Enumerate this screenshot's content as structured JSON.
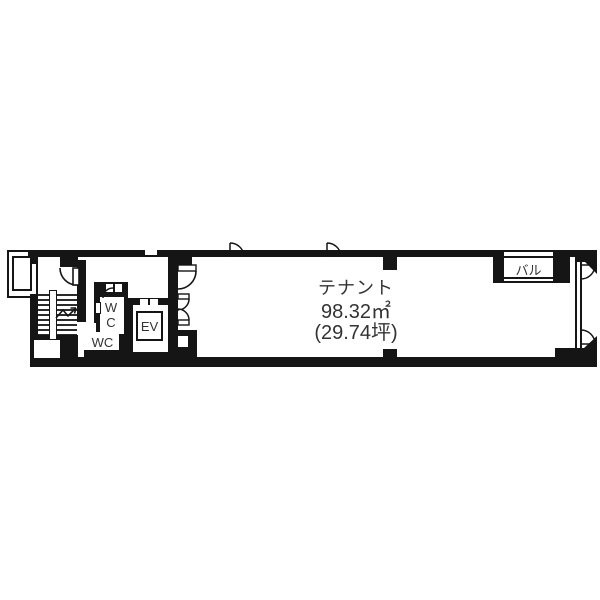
{
  "plan": {
    "tenant": {
      "label": "テナント",
      "area": "98.32㎡",
      "tsubo": "(29.74坪)"
    },
    "balcony": {
      "label": "バル"
    },
    "wc_upper": {
      "label": "WC"
    },
    "wc_lower": {
      "label": "WC"
    },
    "elevator": {
      "label": "EV"
    }
  },
  "colors": {
    "wall": "#151515",
    "text": "#333333",
    "background": "#ffffff"
  }
}
